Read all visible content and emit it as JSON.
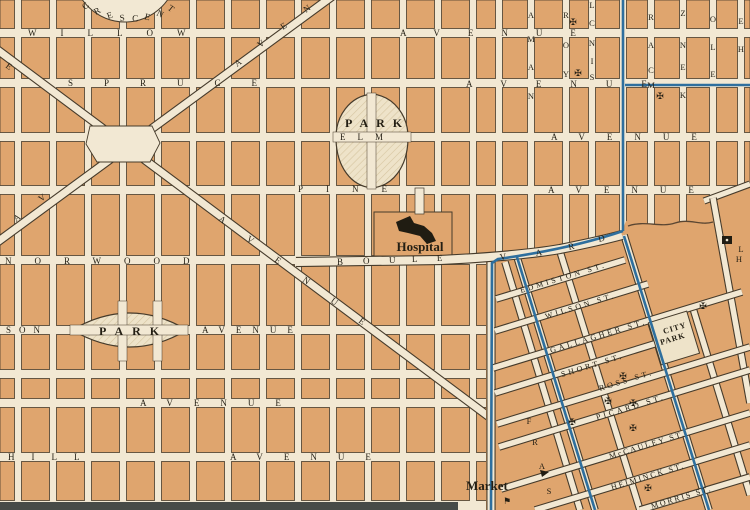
{
  "title": "Vintage City Map",
  "colors": {
    "street": "#f2e8d3",
    "block": "#dfa56e",
    "outline": "#463b2b",
    "blue": "#2e6f9e",
    "text": "#241f14",
    "park_fill": "#eee3c9",
    "park_hatch": "#d6c5a0",
    "band": "#474b48",
    "building": "#201c12",
    "creek": "#5a4632"
  },
  "grid": {
    "cols": [
      18,
      53,
      88,
      123,
      158,
      193,
      228,
      263,
      298,
      333,
      368,
      403,
      438,
      473,
      499,
      531,
      566,
      592,
      623,
      651,
      683,
      713,
      741
    ],
    "rows": [
      33,
      83,
      137,
      190,
      260,
      330,
      374,
      403,
      457,
      505
    ],
    "col_half": 3.5,
    "row_half": 4.5
  },
  "street_labels": [
    {
      "name": "willow-street-label",
      "text": "WILLOW",
      "x": 28,
      "y": 36,
      "ls": 24
    },
    {
      "name": "spruce-street-label",
      "text": "SPRUCE",
      "x": 68,
      "y": 86,
      "ls": 31
    },
    {
      "name": "avenue-row1-label",
      "text": "AVENUE",
      "x": 400,
      "y": 36,
      "ls": 28
    },
    {
      "name": "avenue-row2-label",
      "text": "AVENUE",
      "x": 466,
      "y": 87,
      "ls": 29
    },
    {
      "name": "avenue-row3-label",
      "text": "AVENUE",
      "x": 551,
      "y": 140,
      "ls": 22
    },
    {
      "name": "avenue-row4-label",
      "text": "AVENUE",
      "x": 548,
      "y": 193,
      "ls": 22
    },
    {
      "name": "elm-street-label",
      "text": "ELM",
      "x": 340,
      "y": 140,
      "ls": 12
    },
    {
      "name": "pine-street-label",
      "text": "PINE",
      "x": 298,
      "y": 192,
      "ls": 23
    },
    {
      "name": "norwood-street-label",
      "text": "NORWOOD",
      "x": 5,
      "y": 264,
      "ls": 23
    },
    {
      "name": "son-street-label",
      "text": "SON",
      "x": 6,
      "y": 333,
      "ls": 8
    },
    {
      "name": "avenue-park-row-label",
      "text": "AVENUE",
      "x": 202,
      "y": 333,
      "ls": 11
    },
    {
      "name": "avenue-row6-label",
      "text": "AVENUE",
      "x": 140,
      "y": 406,
      "ls": 21
    },
    {
      "name": "hill-street-label",
      "text": "HILL",
      "x": 8,
      "y": 460,
      "ls": 17
    },
    {
      "name": "avenue-row7-label",
      "text": "AVENUE",
      "x": 230,
      "y": 460,
      "ls": 21
    },
    {
      "name": "park-west-label",
      "text": "PARK",
      "x": 99,
      "y": 335,
      "ls": 9,
      "size": 12,
      "bold": true
    },
    {
      "name": "park-elm-label",
      "text": "PARK",
      "x": 345,
      "y": 127,
      "ls": 8,
      "size": 12,
      "bold": true
    }
  ],
  "letter_labels": {
    "crescent": [
      [
        "C",
        85,
        10,
        -40
      ],
      [
        "R",
        96,
        15,
        -30
      ],
      [
        "E",
        108,
        19,
        -19
      ],
      [
        "S",
        120,
        21,
        -7
      ],
      [
        "C",
        132,
        21,
        4
      ],
      [
        "E",
        144,
        19,
        15
      ],
      [
        "N",
        156,
        15,
        26
      ],
      [
        "T",
        167,
        9,
        38
      ]
    ],
    "boulevard": [
      [
        "B",
        337,
        265,
        0
      ],
      [
        "O",
        363,
        264,
        0
      ],
      [
        "U",
        389,
        263,
        -1
      ],
      [
        "L",
        412,
        262,
        -2
      ],
      [
        "E",
        437,
        261,
        -3
      ],
      [
        "V",
        500,
        260,
        -6
      ],
      [
        "A",
        536,
        256,
        -9
      ],
      [
        "R",
        569,
        250,
        -13
      ],
      [
        "D",
        599,
        242,
        -15
      ]
    ],
    "avenue_d1": [
      [
        "A",
        218,
        220,
        36
      ],
      [
        "V",
        246,
        240,
        36
      ],
      [
        "E",
        274,
        261,
        36
      ],
      [
        "N",
        302,
        281,
        36
      ],
      [
        "U",
        330,
        302,
        36
      ],
      [
        "E",
        358,
        322,
        36
      ],
      [
        "E",
        5,
        67,
        36
      ]
    ],
    "avenue_d2": [
      [
        "A",
        16,
        222,
        -36
      ],
      [
        "V",
        41,
        202,
        -36
      ],
      [
        "A",
        237,
        67,
        -36
      ],
      [
        "V",
        260,
        48,
        -36
      ],
      [
        "E",
        283,
        30,
        -36
      ],
      [
        "N",
        306,
        13,
        -36
      ]
    ]
  },
  "letter_stacks": [
    {
      "name": "nama-street-letters",
      "letters": [
        [
          "A",
          531,
          18
        ],
        [
          "M",
          531,
          42
        ],
        [
          "A",
          531,
          70
        ],
        [
          "N",
          531,
          99
        ]
      ]
    },
    {
      "name": "york-street-letters",
      "letters": [
        [
          "R",
          566,
          18
        ],
        [
          "O",
          566,
          48
        ],
        [
          "Y",
          566,
          77
        ]
      ]
    },
    {
      "name": "sinclair-street-letters",
      "letters": [
        [
          "L",
          592,
          8
        ],
        [
          "C",
          592,
          26
        ],
        [
          "N",
          592,
          46
        ],
        [
          "I",
          592,
          64
        ],
        [
          "S",
          592,
          80
        ]
      ]
    },
    {
      "name": "mcar-street-letters",
      "letters": [
        [
          "R",
          651,
          20
        ],
        [
          "A",
          651,
          48
        ],
        [
          "C",
          651,
          73
        ],
        [
          "M",
          651,
          88
        ]
      ]
    },
    {
      "name": "kenzie-street-letters",
      "letters": [
        [
          "Z",
          683,
          16
        ],
        [
          "N",
          683,
          48
        ],
        [
          "E",
          683,
          70
        ],
        [
          "K",
          683,
          98
        ]
      ]
    },
    {
      "name": "ole-street-letters",
      "letters": [
        [
          "O",
          713,
          22
        ],
        [
          "L",
          713,
          50
        ],
        [
          "E",
          713,
          77
        ]
      ]
    },
    {
      "name": "he-street-letters",
      "letters": [
        [
          "E",
          741,
          24
        ],
        [
          "H",
          741,
          52
        ]
      ]
    },
    {
      "name": "fraser-street-letters",
      "letters": [
        [
          "F",
          529,
          424
        ],
        [
          "R",
          535,
          445
        ],
        [
          "A",
          542,
          469
        ],
        [
          "S",
          549,
          494
        ]
      ]
    },
    {
      "name": "edge-letters",
      "letters": [
        [
          "L",
          741,
          252
        ],
        [
          "H",
          739,
          262
        ]
      ]
    }
  ],
  "old_town": {
    "streets": [
      {
        "name": "edmiston-street",
        "seg": [
          496,
          299,
          625,
          260
        ]
      },
      {
        "name": "wilson-street",
        "seg": [
          495,
          331,
          648,
          284
        ]
      },
      {
        "name": "gallagher-street",
        "seg": [
          493,
          368,
          742,
          292
        ]
      },
      {
        "name": "short-street",
        "seg": [
          495,
          393,
          690,
          333
        ]
      },
      {
        "name": "ross-street",
        "seg": [
          497,
          424,
          750,
          347
        ]
      },
      {
        "name": "picard-street",
        "seg": [
          499,
          447,
          750,
          370
        ]
      },
      {
        "name": "mccauley-street",
        "seg": [
          501,
          489,
          750,
          413
        ]
      },
      {
        "name": "heiminck-street",
        "seg": [
          535,
          510,
          750,
          445
        ]
      },
      {
        "name": "morris-street",
        "seg": [
          640,
          510,
          750,
          477
        ]
      }
    ],
    "cross_streets": [
      {
        "name": "cross-street-1",
        "seg": [
          505,
          262,
          580,
          510
        ]
      },
      {
        "name": "cross-street-2",
        "seg": [
          517,
          257,
          595,
          510
        ]
      },
      {
        "name": "cross-street-3",
        "seg": [
          558,
          245,
          640,
          510
        ]
      },
      {
        "name": "cross-street-4",
        "seg": [
          624,
          235,
          709,
          510
        ]
      },
      {
        "name": "cross-street-5",
        "seg": [
          692,
          305,
          750,
          495
        ]
      },
      {
        "name": "road-b",
        "seg": [
          713,
          198,
          750,
          403
        ]
      },
      {
        "name": "market-street",
        "seg": [
          491,
          258,
          491,
          510
        ]
      }
    ],
    "labels": [
      {
        "name": "edmiston-label",
        "text": "EDMISTON ST.",
        "x": 521,
        "y": 293,
        "rot": -17,
        "ls": 3
      },
      {
        "name": "wilson-label",
        "text": "WILSON ST.",
        "x": 546,
        "y": 319,
        "rot": -17,
        "ls": 3
      },
      {
        "name": "gallagher-label",
        "text": "GALLAGHER ST.",
        "x": 551,
        "y": 353,
        "rot": -17,
        "ls": 3
      },
      {
        "name": "short-label",
        "text": "SHORT ST.",
        "x": 562,
        "y": 377,
        "rot": -17,
        "ls": 3
      },
      {
        "name": "ross-label",
        "text": "ROSS ST.",
        "x": 600,
        "y": 391,
        "rot": -17,
        "ls": 3
      },
      {
        "name": "picard-label",
        "text": "PICARD ST.",
        "x": 597,
        "y": 420,
        "rot": -17,
        "ls": 3
      },
      {
        "name": "mccauley-label",
        "text": "McCAULEY ST.",
        "x": 610,
        "y": 459,
        "rot": -17,
        "ls": 2
      },
      {
        "name": "heiminck-label",
        "text": "HEIMINCK ST.",
        "x": 612,
        "y": 490,
        "rot": -17,
        "ls": 2
      },
      {
        "name": "morris-label",
        "text": "MORRIS ST.",
        "x": 652,
        "y": 509,
        "rot": -17,
        "ls": 2
      },
      {
        "name": "city-park-label-1",
        "text": "CITY",
        "x": 664,
        "y": 334,
        "rot": -17,
        "ls": 1,
        "bold": true
      },
      {
        "name": "city-park-label-2",
        "text": "PARK",
        "x": 661,
        "y": 345,
        "rot": -17,
        "ls": 1,
        "bold": true
      }
    ],
    "patch": "486,262 565,252 620,236 626,221 660,225 700,219 706,201 750,183 750,510 486,510",
    "city_park_rect": {
      "x": 654,
      "y": 316,
      "w": 40,
      "h": 44,
      "rot": -17,
      "cx": 674,
      "cy": 338
    }
  },
  "pois": {
    "hospital": {
      "label": "Hospital",
      "x": 420,
      "y": 251
    },
    "market": {
      "label": "Market",
      "x": 466,
      "y": 490
    },
    "market_flag": {
      "glyph": "⚑",
      "x": 503,
      "y": 504
    }
  },
  "crosses": [
    [
      573,
      25
    ],
    [
      578,
      76
    ],
    [
      660,
      99
    ],
    [
      623,
      379
    ],
    [
      608,
      404
    ],
    [
      633,
      406
    ],
    [
      572,
      425
    ],
    [
      633,
      431
    ],
    [
      648,
      491
    ],
    [
      703,
      309
    ]
  ],
  "geometry": {
    "d1": [
      -5,
      48,
      500,
      425
    ],
    "d2": [
      -8,
      246,
      338,
      -8
    ],
    "plaza": "90,126 152,126 160,143 150,162 97,162 86,144",
    "crescent": {
      "cx": 125,
      "cy": -30,
      "r": 52
    },
    "egg_park": "M372,94 C394,96 409,116 408,140 C407,167 393,186 372,188 C351,186 337,167 336,140 C335,116 350,96 372,94 Z",
    "lens_park": "M72,330 Q130,296 187,330 Q130,364 72,330 Z",
    "boulevard": "M296,262 L440,260 Q520,256 560,249 Q600,241 622,235",
    "hospital_block": {
      "x": 374,
      "y": 212,
      "w": 78,
      "h": 44
    },
    "hospital_stub": {
      "x": 415,
      "y": 188,
      "w": 9,
      "h": 26
    },
    "hospital_building": "M396,222 L410,216 L414,223 L424,226 L432,233 L436,241 L427,244 L420,236 L408,233 L399,231 Z",
    "creek": "M628,226 C645,220 660,228 675,223 C690,218 700,226 713,222",
    "road_a": [
      704,
      201,
      750,
      184
    ],
    "band": {
      "x": 0,
      "y": 502,
      "w": 458,
      "h": 8
    },
    "small_building": {
      "x": 722,
      "y": 236,
      "w": 10,
      "h": 8
    },
    "triangle_building": "M540,470 l9,2 l-7,5 z",
    "blue_paths": [
      "M623,0 L623,231",
      "M625,85 L750,85",
      "M623,231 Q570,249 498,259 L492,263 L491,510",
      "M517,257 L595,510",
      "M624,236 L709,510"
    ]
  }
}
